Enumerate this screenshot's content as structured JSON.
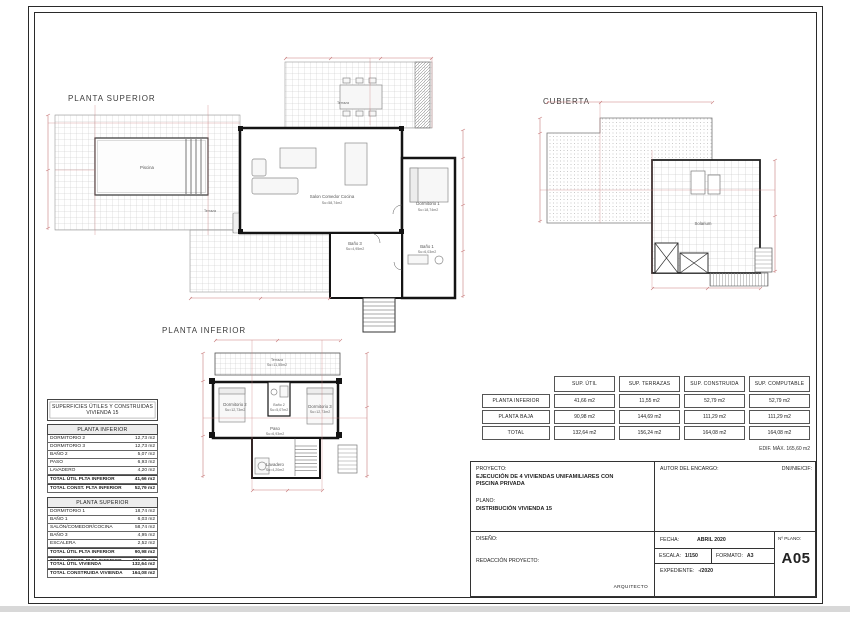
{
  "page": {
    "headings": {
      "planta_superior": "PLANTA SUPERIOR",
      "cubierta": "CUBIERTA",
      "planta_inferior": "PLANTA INFERIOR"
    }
  },
  "plans": {
    "superior": {
      "labels": {
        "piscina": "Piscina",
        "terraza_left": "Terraza",
        "terraza_top": "Terraza",
        "salon": "Salon  Comedor  Cocina",
        "salon_area": "Su=58,74m2",
        "dormitorio1": "Dormitorio 1",
        "dormitorio1_area": "Su=18,74m2",
        "bano1": "Baño 1",
        "bano1_area": "Su=6,03m2",
        "bano3": "Baño 3",
        "bano3_area": "Su=4,95m2"
      }
    },
    "inferior": {
      "labels": {
        "terraza": "Terraza",
        "terraza_area": "Su=11,55m2",
        "dormitorio2": "Dormitorio 2",
        "dormitorio2_area": "Su=12,73m2",
        "dormitorio3": "Dormitorio 3",
        "dormitorio3_area": "Su=12,73m2",
        "bano2": "Baño 2",
        "bano2_area": "Su=5,07m2",
        "paso": "Paso",
        "paso_area": "Su=6,93m2",
        "lavadero": "Lavadero",
        "lavadero_area": "Su=4,20m2"
      }
    },
    "cubierta": {
      "labels": {
        "solarium": "Solarium"
      }
    }
  },
  "superficies": {
    "title_line1": "SUPERFICIES ÚTILES Y CONSTRUIDAS",
    "title_line2": "VIVIENDA 15",
    "inferior": {
      "header": "PLANTA INFERIOR",
      "rows": [
        [
          "DORMITORIO 2",
          "12,73 m2"
        ],
        [
          "DORMITORIO 3",
          "12,73 m2"
        ],
        [
          "BAÑO 2",
          "5,07 m2"
        ],
        [
          "PASO",
          "6,93 m2"
        ],
        [
          "LAVADERO",
          "4,20 m2"
        ]
      ],
      "totals": [
        [
          "TOTAL ÚTIL PLTA INFERIOR",
          "41,66 m2"
        ],
        [
          "TOTAL CONST. PLTA INFERIOR",
          "52,79 m2"
        ]
      ]
    },
    "superior": {
      "header": "PLANTA SUPERIOR",
      "rows": [
        [
          "DORMITORIO 1",
          "18,74 m2"
        ],
        [
          "BAÑO 1",
          "6,03 m2"
        ],
        [
          "SALÓN/COMEDOR/COCINA",
          "58,74 m2"
        ],
        [
          "BAÑO 3",
          "4,95 m2"
        ],
        [
          "ESCALERA",
          "2,52 m2"
        ]
      ],
      "totals": [
        [
          "TOTAL ÚTIL PLTA INFERIOR",
          "90,98 m2"
        ],
        [
          "TOTAL CONST. PLTA INFERIOR",
          "111,29 m2"
        ]
      ]
    },
    "vivienda_totals": [
      [
        "TOTAL ÚTIL VIVIENDA",
        "132,64 m2"
      ],
      [
        "TOTAL CONSTRUIDA VIVIENDA",
        "164,08 m2"
      ]
    ]
  },
  "summary_table": {
    "columns": [
      "",
      "SUP. ÚTIL",
      "SUP. TERRAZAS",
      "SUP. CONSTRUIDA",
      "SUP. COMPUTABLE"
    ],
    "rows": [
      {
        "label": "PLANTA INFERIOR",
        "values": [
          "41,66 m2",
          "11,55 m2",
          "52,79 m2",
          "52,79 m2"
        ]
      },
      {
        "label": "PLANTA BAJA",
        "values": [
          "90,98 m2",
          "144,69 m2",
          "111,29 m2",
          "111,29 m2"
        ]
      },
      {
        "label": "TOTAL",
        "values": [
          "132,64 m2",
          "156,24 m2",
          "164,08 m2",
          "164,08 m2"
        ]
      }
    ],
    "footnote": "EDIF. MÁX. 165,60 m2"
  },
  "titleblock": {
    "proyecto_label": "PROYECTO:",
    "proyecto_value": "EJECUCIÓN DE 4 VIVIENDAS UNIFAMILIARES CON PISCINA PRIVADA",
    "plano_label": "PLANO:",
    "plano_value": "DISTRIBUCIÓN VIVIENDA 15",
    "autor_label": "AUTOR DEL ENCARGO:",
    "dni_label": "DNI/NIE/CIF:",
    "diseno_label": "DISEÑO:",
    "redaccion_label": "REDACCIÓN PROYECTO:",
    "arquitecto_label": "ARQUITECTO",
    "fecha_label": "FECHA:",
    "fecha_value": "ABRIL 2020",
    "escala_label": "ESCALA:",
    "escala_value": "1/150",
    "formato_label": "FORMATO:",
    "formato_value": "A3",
    "expediente_label": "EXPEDIENTE:",
    "expediente_value": "-/2020",
    "num_plano_label": "Nº PLANO:",
    "num_plano_value": "A05"
  },
  "colors": {
    "dimension": "#c97d7d",
    "wall": "#141414",
    "tile_grid": "#c4c4c4"
  }
}
